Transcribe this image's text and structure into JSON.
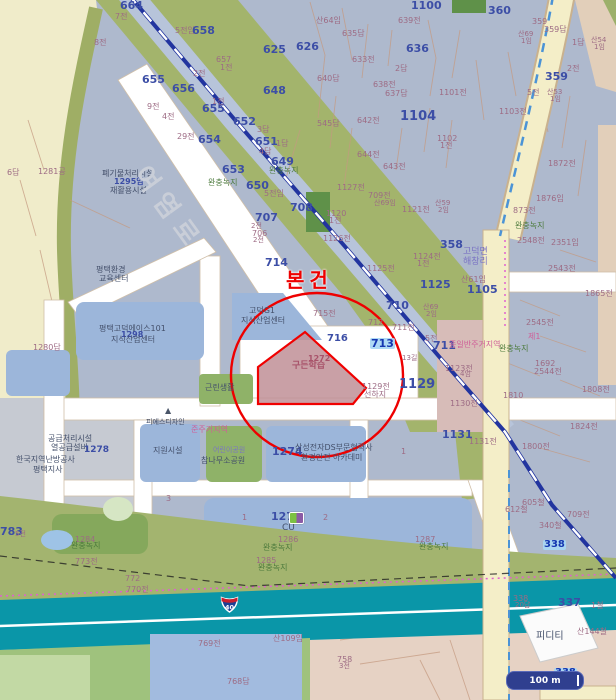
{
  "map": {
    "subject_label": "본건",
    "subject_parcel": {
      "number": "1272",
      "text": "구든학습"
    },
    "route_shield": "40",
    "scale_bar_label": "100 m",
    "colors": {
      "accent_red": "#ee0000",
      "subject_fill": "#c08f96",
      "buffer_green": "#a3b46f",
      "parcel_blue": "#9cb6da",
      "expressway_teal": "#0a96a8",
      "base_urban": "#aeb9cd",
      "road_cream": "#f4eec8",
      "rail_blue": "#22349f",
      "farm_yellow": "#f0ecca"
    },
    "labels": [
      {
        "t": "664",
        "x": 120,
        "y": 0,
        "c": "num",
        "s": 11
      },
      {
        "t": "7전",
        "x": 115,
        "y": 13,
        "c": "sm"
      },
      {
        "t": "657",
        "x": 216,
        "y": 56,
        "c": "sm"
      },
      {
        "t": "1전",
        "x": 220,
        "y": 64,
        "c": "sm"
      },
      {
        "t": "8전",
        "x": 94,
        "y": 39,
        "c": "sm"
      },
      {
        "t": "5전임",
        "x": 175,
        "y": 27,
        "c": "sm"
      },
      {
        "t": "658",
        "x": 192,
        "y": 25,
        "c": "num",
        "s": 11
      },
      {
        "t": "625",
        "x": 263,
        "y": 44,
        "c": "num",
        "s": 11
      },
      {
        "t": "626",
        "x": 296,
        "y": 41,
        "c": "num",
        "s": 11
      },
      {
        "t": "655",
        "x": 142,
        "y": 74,
        "c": "num",
        "s": 11
      },
      {
        "t": "2전",
        "x": 193,
        "y": 70,
        "c": "sm"
      },
      {
        "t": "656",
        "x": 172,
        "y": 83,
        "c": "num",
        "s": 11
      },
      {
        "t": "648",
        "x": 263,
        "y": 85,
        "c": "num",
        "s": 11
      },
      {
        "t": "655",
        "x": 202,
        "y": 103,
        "c": "num",
        "s": 11
      },
      {
        "t": "1전",
        "x": 212,
        "y": 98,
        "c": "sm"
      },
      {
        "t": "9전",
        "x": 147,
        "y": 103,
        "c": "sm"
      },
      {
        "t": "4전",
        "x": 162,
        "y": 113,
        "c": "sm"
      },
      {
        "t": "652",
        "x": 233,
        "y": 116,
        "c": "num",
        "s": 11
      },
      {
        "t": "3답",
        "x": 257,
        "y": 126,
        "c": "sm"
      },
      {
        "t": "651",
        "x": 255,
        "y": 136,
        "c": "num",
        "s": 11
      },
      {
        "t": "1답",
        "x": 276,
        "y": 140,
        "c": "sm"
      },
      {
        "t": "29전",
        "x": 177,
        "y": 133,
        "c": "sm"
      },
      {
        "t": "654",
        "x": 198,
        "y": 134,
        "c": "num",
        "s": 11
      },
      {
        "t": "4답",
        "x": 259,
        "y": 148,
        "c": "sm"
      },
      {
        "t": "649",
        "x": 271,
        "y": 156,
        "c": "num",
        "s": 11
      },
      {
        "t": "완충녹지",
        "x": 269,
        "y": 167,
        "c": "grn"
      },
      {
        "t": "완충녹지",
        "x": 208,
        "y": 179,
        "c": "grn"
      },
      {
        "t": "653",
        "x": 222,
        "y": 164,
        "c": "num",
        "s": 11
      },
      {
        "t": "650",
        "x": 246,
        "y": 180,
        "c": "num",
        "s": 11
      },
      {
        "t": "5전임",
        "x": 264,
        "y": 190,
        "c": "sm"
      },
      {
        "t": "707",
        "x": 255,
        "y": 212,
        "c": "num",
        "s": 11
      },
      {
        "t": "2전",
        "x": 251,
        "y": 223,
        "c": "sm",
        "s": 7
      },
      {
        "t": "706",
        "x": 252,
        "y": 230,
        "c": "sm"
      },
      {
        "t": "2전",
        "x": 253,
        "y": 237,
        "c": "sm",
        "s": 7
      },
      {
        "t": "708",
        "x": 290,
        "y": 202,
        "c": "num",
        "s": 11
      },
      {
        "t": "714",
        "x": 265,
        "y": 257,
        "c": "num",
        "s": 11
      },
      {
        "t": "715전",
        "x": 313,
        "y": 310,
        "c": "sm"
      },
      {
        "t": "716",
        "x": 327,
        "y": 334,
        "c": "num",
        "s": 10
      },
      {
        "t": "1126전",
        "x": 323,
        "y": 235,
        "c": "sm"
      },
      {
        "t": "6답",
        "x": 7,
        "y": 169,
        "c": "sm"
      },
      {
        "t": "1281공",
        "x": 38,
        "y": 168,
        "c": "sm"
      },
      {
        "t": "1280답",
        "x": 33,
        "y": 344,
        "c": "sm"
      },
      {
        "t": "폐기물처리시설",
        "x": 102,
        "y": 170,
        "c": "fac"
      },
      {
        "t": "1295임",
        "x": 114,
        "y": 178,
        "c": "num",
        "s": 8
      },
      {
        "t": "재활용시설",
        "x": 110,
        "y": 187,
        "c": "fac"
      },
      {
        "t": "평택환경",
        "x": 96,
        "y": 266,
        "c": "fac"
      },
      {
        "t": "교육센터",
        "x": 99,
        "y": 275,
        "c": "fac"
      },
      {
        "t": "산64임",
        "x": 316,
        "y": 17,
        "c": "sm"
      },
      {
        "t": "639전",
        "x": 398,
        "y": 17,
        "c": "sm"
      },
      {
        "t": "1100",
        "x": 411,
        "y": 0,
        "c": "num",
        "s": 11
      },
      {
        "t": "635답",
        "x": 342,
        "y": 30,
        "c": "sm"
      },
      {
        "t": "360",
        "x": 488,
        "y": 5,
        "c": "num",
        "s": 11
      },
      {
        "t": "636",
        "x": 406,
        "y": 43,
        "c": "num",
        "s": 11
      },
      {
        "t": "633전",
        "x": 352,
        "y": 56,
        "c": "sm"
      },
      {
        "t": "2답",
        "x": 395,
        "y": 65,
        "c": "sm"
      },
      {
        "t": "640답",
        "x": 317,
        "y": 75,
        "c": "sm"
      },
      {
        "t": "638전",
        "x": 373,
        "y": 81,
        "c": "sm"
      },
      {
        "t": "637답",
        "x": 385,
        "y": 90,
        "c": "sm"
      },
      {
        "t": "1101전",
        "x": 439,
        "y": 89,
        "c": "sm"
      },
      {
        "t": "359",
        "x": 532,
        "y": 18,
        "c": "sm"
      },
      {
        "t": "359답",
        "x": 544,
        "y": 26,
        "c": "sm"
      },
      {
        "t": "산69",
        "x": 518,
        "y": 31,
        "c": "sm",
        "s": 7
      },
      {
        "t": "1임",
        "x": 521,
        "y": 38,
        "c": "sm",
        "s": 7
      },
      {
        "t": "1답",
        "x": 572,
        "y": 39,
        "c": "sm"
      },
      {
        "t": "산54",
        "x": 591,
        "y": 37,
        "c": "sm",
        "s": 7
      },
      {
        "t": "1임",
        "x": 594,
        "y": 44,
        "c": "sm",
        "s": 7
      },
      {
        "t": "2전",
        "x": 567,
        "y": 65,
        "c": "sm"
      },
      {
        "t": "359",
        "x": 545,
        "y": 71,
        "c": "num",
        "s": 11
      },
      {
        "t": "산53",
        "x": 547,
        "y": 89,
        "c": "sm",
        "s": 7
      },
      {
        "t": "1임",
        "x": 550,
        "y": 96,
        "c": "sm",
        "s": 7
      },
      {
        "t": "5전",
        "x": 527,
        "y": 89,
        "c": "sm"
      },
      {
        "t": "1103전",
        "x": 499,
        "y": 108,
        "c": "sm"
      },
      {
        "t": "545답",
        "x": 317,
        "y": 120,
        "c": "sm"
      },
      {
        "t": "642전",
        "x": 357,
        "y": 117,
        "c": "sm"
      },
      {
        "t": "1104",
        "x": 400,
        "y": 110,
        "c": "num",
        "s": 13
      },
      {
        "t": "1102",
        "x": 437,
        "y": 135,
        "c": "sm"
      },
      {
        "t": "1전",
        "x": 440,
        "y": 142,
        "c": "sm"
      },
      {
        "t": "644전",
        "x": 357,
        "y": 151,
        "c": "sm"
      },
      {
        "t": "643전",
        "x": 383,
        "y": 163,
        "c": "sm"
      },
      {
        "t": "1127전",
        "x": 337,
        "y": 184,
        "c": "sm"
      },
      {
        "t": "709전",
        "x": 368,
        "y": 192,
        "c": "sm"
      },
      {
        "t": "산69임",
        "x": 374,
        "y": 200,
        "c": "sm",
        "s": 7
      },
      {
        "t": "1120",
        "x": 326,
        "y": 210,
        "c": "sm"
      },
      {
        "t": "1전",
        "x": 329,
        "y": 217,
        "c": "sm"
      },
      {
        "t": "1121전",
        "x": 402,
        "y": 206,
        "c": "sm"
      },
      {
        "t": "산59",
        "x": 435,
        "y": 200,
        "c": "sm",
        "s": 7
      },
      {
        "t": "2임",
        "x": 438,
        "y": 207,
        "c": "sm",
        "s": 7
      },
      {
        "t": "1872전",
        "x": 548,
        "y": 160,
        "c": "sm"
      },
      {
        "t": "1876임",
        "x": 536,
        "y": 195,
        "c": "sm"
      },
      {
        "t": "873전",
        "x": 513,
        "y": 207,
        "c": "sm"
      },
      {
        "t": "완충녹지",
        "x": 515,
        "y": 222,
        "c": "grn"
      },
      {
        "t": "1124전",
        "x": 413,
        "y": 253,
        "c": "sm"
      },
      {
        "t": "1전",
        "x": 417,
        "y": 260,
        "c": "sm"
      },
      {
        "t": "1125전",
        "x": 367,
        "y": 265,
        "c": "sm"
      },
      {
        "t": "1125",
        "x": 420,
        "y": 279,
        "c": "num",
        "s": 11
      },
      {
        "t": "358",
        "x": 440,
        "y": 239,
        "c": "num",
        "s": 11
      },
      {
        "t": "고덕면",
        "x": 463,
        "y": 248,
        "c": "pur",
        "s": 9
      },
      {
        "t": "해창리",
        "x": 463,
        "y": 258,
        "c": "pur",
        "s": 9
      },
      {
        "t": "산61임",
        "x": 461,
        "y": 276,
        "c": "sm"
      },
      {
        "t": "1105",
        "x": 467,
        "y": 284,
        "c": "num",
        "s": 11
      },
      {
        "t": "2548전",
        "x": 517,
        "y": 237,
        "c": "sm"
      },
      {
        "t": "2351임",
        "x": 551,
        "y": 239,
        "c": "sm"
      },
      {
        "t": "2543전",
        "x": 548,
        "y": 265,
        "c": "sm"
      },
      {
        "t": "1865전",
        "x": 585,
        "y": 290,
        "c": "sm"
      },
      {
        "t": "2545전",
        "x": 526,
        "y": 319,
        "c": "sm"
      },
      {
        "t": "산69",
        "x": 423,
        "y": 304,
        "c": "sm",
        "s": 7
      },
      {
        "t": "2임",
        "x": 426,
        "y": 311,
        "c": "sm",
        "s": 7
      },
      {
        "t": "710",
        "x": 386,
        "y": 300,
        "c": "num",
        "s": 11
      },
      {
        "t": "712",
        "x": 368,
        "y": 319,
        "c": "sm"
      },
      {
        "t": "711전",
        "x": 392,
        "y": 324,
        "c": "sm"
      },
      {
        "t": "713",
        "x": 370,
        "y": 338,
        "c": "hl",
        "s": 11
      },
      {
        "t": "5전",
        "x": 425,
        "y": 335,
        "c": "sm"
      },
      {
        "t": "711",
        "x": 433,
        "y": 340,
        "c": "num",
        "s": 11
      },
      {
        "t": "1129전",
        "x": 362,
        "y": 383,
        "c": "sm"
      },
      {
        "t": "선하지",
        "x": 364,
        "y": 391,
        "c": "sm"
      },
      {
        "t": "1129",
        "x": 399,
        "y": 378,
        "c": "num",
        "s": 13
      },
      {
        "t": "13길",
        "x": 402,
        "y": 355,
        "c": "sm",
        "s": 7
      },
      {
        "t": "제1",
        "x": 528,
        "y": 333,
        "c": "pnk"
      },
      {
        "t": "종일반주거지역",
        "x": 449,
        "y": 341,
        "c": "pnk"
      },
      {
        "t": "완충녹지",
        "x": 499,
        "y": 345,
        "c": "grn"
      },
      {
        "t": "1123전",
        "x": 445,
        "y": 365,
        "c": "sm"
      },
      {
        "t": "4임",
        "x": 460,
        "y": 371,
        "c": "sm",
        "s": 7
      },
      {
        "t": "1130전",
        "x": 450,
        "y": 400,
        "c": "sm"
      },
      {
        "t": "1810",
        "x": 503,
        "y": 392,
        "c": "sm"
      },
      {
        "t": "1808전",
        "x": 582,
        "y": 386,
        "c": "sm"
      },
      {
        "t": "1692",
        "x": 535,
        "y": 360,
        "c": "sm"
      },
      {
        "t": "2544전",
        "x": 534,
        "y": 368,
        "c": "sm"
      },
      {
        "t": "1824전",
        "x": 570,
        "y": 423,
        "c": "sm"
      },
      {
        "t": "1800전",
        "x": 522,
        "y": 443,
        "c": "sm"
      },
      {
        "t": "1131",
        "x": 442,
        "y": 429,
        "c": "num",
        "s": 11
      },
      {
        "t": "1131전",
        "x": 469,
        "y": 438,
        "c": "sm"
      },
      {
        "t": "고덕G1",
        "x": 249,
        "y": 307,
        "c": "fac"
      },
      {
        "t": "지식산업센터",
        "x": 241,
        "y": 317,
        "c": "fac"
      },
      {
        "t": "평택고덕에이스101",
        "x": 99,
        "y": 325,
        "c": "fac"
      },
      {
        "t": "1298",
        "x": 121,
        "y": 331,
        "c": "num",
        "s": 8
      },
      {
        "t": "지식산업센터",
        "x": 111,
        "y": 336,
        "c": "fac"
      },
      {
        "t": "근린생활",
        "x": 205,
        "y": 384,
        "c": "fac"
      },
      {
        "t": "1272",
        "x": 308,
        "y": 355,
        "c": "pr"
      },
      {
        "t": "구든학습",
        "x": 292,
        "y": 362,
        "c": "pr",
        "s": 9
      },
      {
        "t": "준주거지역",
        "x": 191,
        "y": 426,
        "c": "pnk"
      },
      {
        "t": "피에스디자인",
        "x": 146,
        "y": 419,
        "c": "fac",
        "s": 7
      },
      {
        "t": "지원시설",
        "x": 153,
        "y": 447,
        "c": "fac"
      },
      {
        "t": "어린이공원",
        "x": 213,
        "y": 447,
        "c": "pur",
        "s": 7
      },
      {
        "t": "참나무소공원",
        "x": 201,
        "y": 457,
        "c": "fac"
      },
      {
        "t": "1274",
        "x": 272,
        "y": 446,
        "c": "num",
        "s": 11
      },
      {
        "t": "삼성전자DS부문협력사",
        "x": 295,
        "y": 444,
        "c": "fac"
      },
      {
        "t": "환경안전 아카데미",
        "x": 301,
        "y": 454,
        "c": "fac"
      },
      {
        "t": "공급처리시설",
        "x": 48,
        "y": 435,
        "c": "fac"
      },
      {
        "t": "열공급설비",
        "x": 51,
        "y": 444,
        "c": "fac"
      },
      {
        "t": "1278",
        "x": 84,
        "y": 446,
        "c": "num",
        "s": 9
      },
      {
        "t": "한국지역난방공사",
        "x": 16,
        "y": 456,
        "c": "fac"
      },
      {
        "t": "평택지사",
        "x": 33,
        "y": 466,
        "c": "fac"
      },
      {
        "t": "1",
        "x": 401,
        "y": 448,
        "c": "sm"
      },
      {
        "t": "3",
        "x": 166,
        "y": 495,
        "c": "sm"
      },
      {
        "t": "1",
        "x": 242,
        "y": 514,
        "c": "sm"
      },
      {
        "t": "2",
        "x": 323,
        "y": 514,
        "c": "sm"
      },
      {
        "t": "1277",
        "x": 271,
        "y": 511,
        "c": "num",
        "s": 11
      },
      {
        "t": "CU",
        "x": 282,
        "y": 524,
        "c": "fac",
        "s": 9
      },
      {
        "t": "1286",
        "x": 278,
        "y": 536,
        "c": "sm"
      },
      {
        "t": "완충녹지",
        "x": 263,
        "y": 544,
        "c": "grn"
      },
      {
        "t": "783",
        "x": 0,
        "y": 526,
        "c": "num",
        "s": 11
      },
      {
        "t": "5전",
        "x": 15,
        "y": 531,
        "c": "sm",
        "s": 7
      },
      {
        "t": "1284",
        "x": 75,
        "y": 536,
        "c": "sm"
      },
      {
        "t": "완충녹지",
        "x": 71,
        "y": 542,
        "c": "grn"
      },
      {
        "t": "773전",
        "x": 75,
        "y": 558,
        "c": "sm"
      },
      {
        "t": "772",
        "x": 125,
        "y": 575,
        "c": "sm"
      },
      {
        "t": "770전",
        "x": 126,
        "y": 586,
        "c": "sm"
      },
      {
        "t": "1285",
        "x": 256,
        "y": 557,
        "c": "sm"
      },
      {
        "t": "완충녹지",
        "x": 258,
        "y": 564,
        "c": "grn"
      },
      {
        "t": "769전",
        "x": 198,
        "y": 640,
        "c": "sm"
      },
      {
        "t": "768답",
        "x": 227,
        "y": 678,
        "c": "sm"
      },
      {
        "t": "산109임",
        "x": 273,
        "y": 635,
        "c": "sm"
      },
      {
        "t": "758",
        "x": 337,
        "y": 656,
        "c": "sm"
      },
      {
        "t": "3전",
        "x": 339,
        "y": 663,
        "c": "sm",
        "s": 7
      },
      {
        "t": "1287",
        "x": 415,
        "y": 536,
        "c": "sm"
      },
      {
        "t": "완충녹지",
        "x": 419,
        "y": 543,
        "c": "grn"
      },
      {
        "t": "605철",
        "x": 522,
        "y": 499,
        "c": "sm"
      },
      {
        "t": "612철",
        "x": 505,
        "y": 506,
        "c": "sm"
      },
      {
        "t": "709전",
        "x": 567,
        "y": 511,
        "c": "sm"
      },
      {
        "t": "340철",
        "x": 539,
        "y": 522,
        "c": "sm"
      },
      {
        "t": "338",
        "x": 543,
        "y": 540,
        "c": "hl",
        "s": 10
      },
      {
        "t": "338",
        "x": 513,
        "y": 595,
        "c": "sm"
      },
      {
        "t": "20답",
        "x": 515,
        "y": 602,
        "c": "sm",
        "s": 7
      },
      {
        "t": "337",
        "x": 558,
        "y": 597,
        "c": "num",
        "s": 11
      },
      {
        "t": "1철",
        "x": 591,
        "y": 602,
        "c": "sm"
      },
      {
        "t": "산144철",
        "x": 577,
        "y": 628,
        "c": "sm"
      },
      {
        "t": "피디티",
        "x": 536,
        "y": 632,
        "c": "fac",
        "s": 10
      },
      {
        "t": "338",
        "x": 554,
        "y": 668,
        "c": "hl",
        "s": 10
      },
      {
        "t": "여염로",
        "x": 150,
        "y": 162,
        "c": "rd",
        "s": 26,
        "r": 54
      }
    ]
  }
}
